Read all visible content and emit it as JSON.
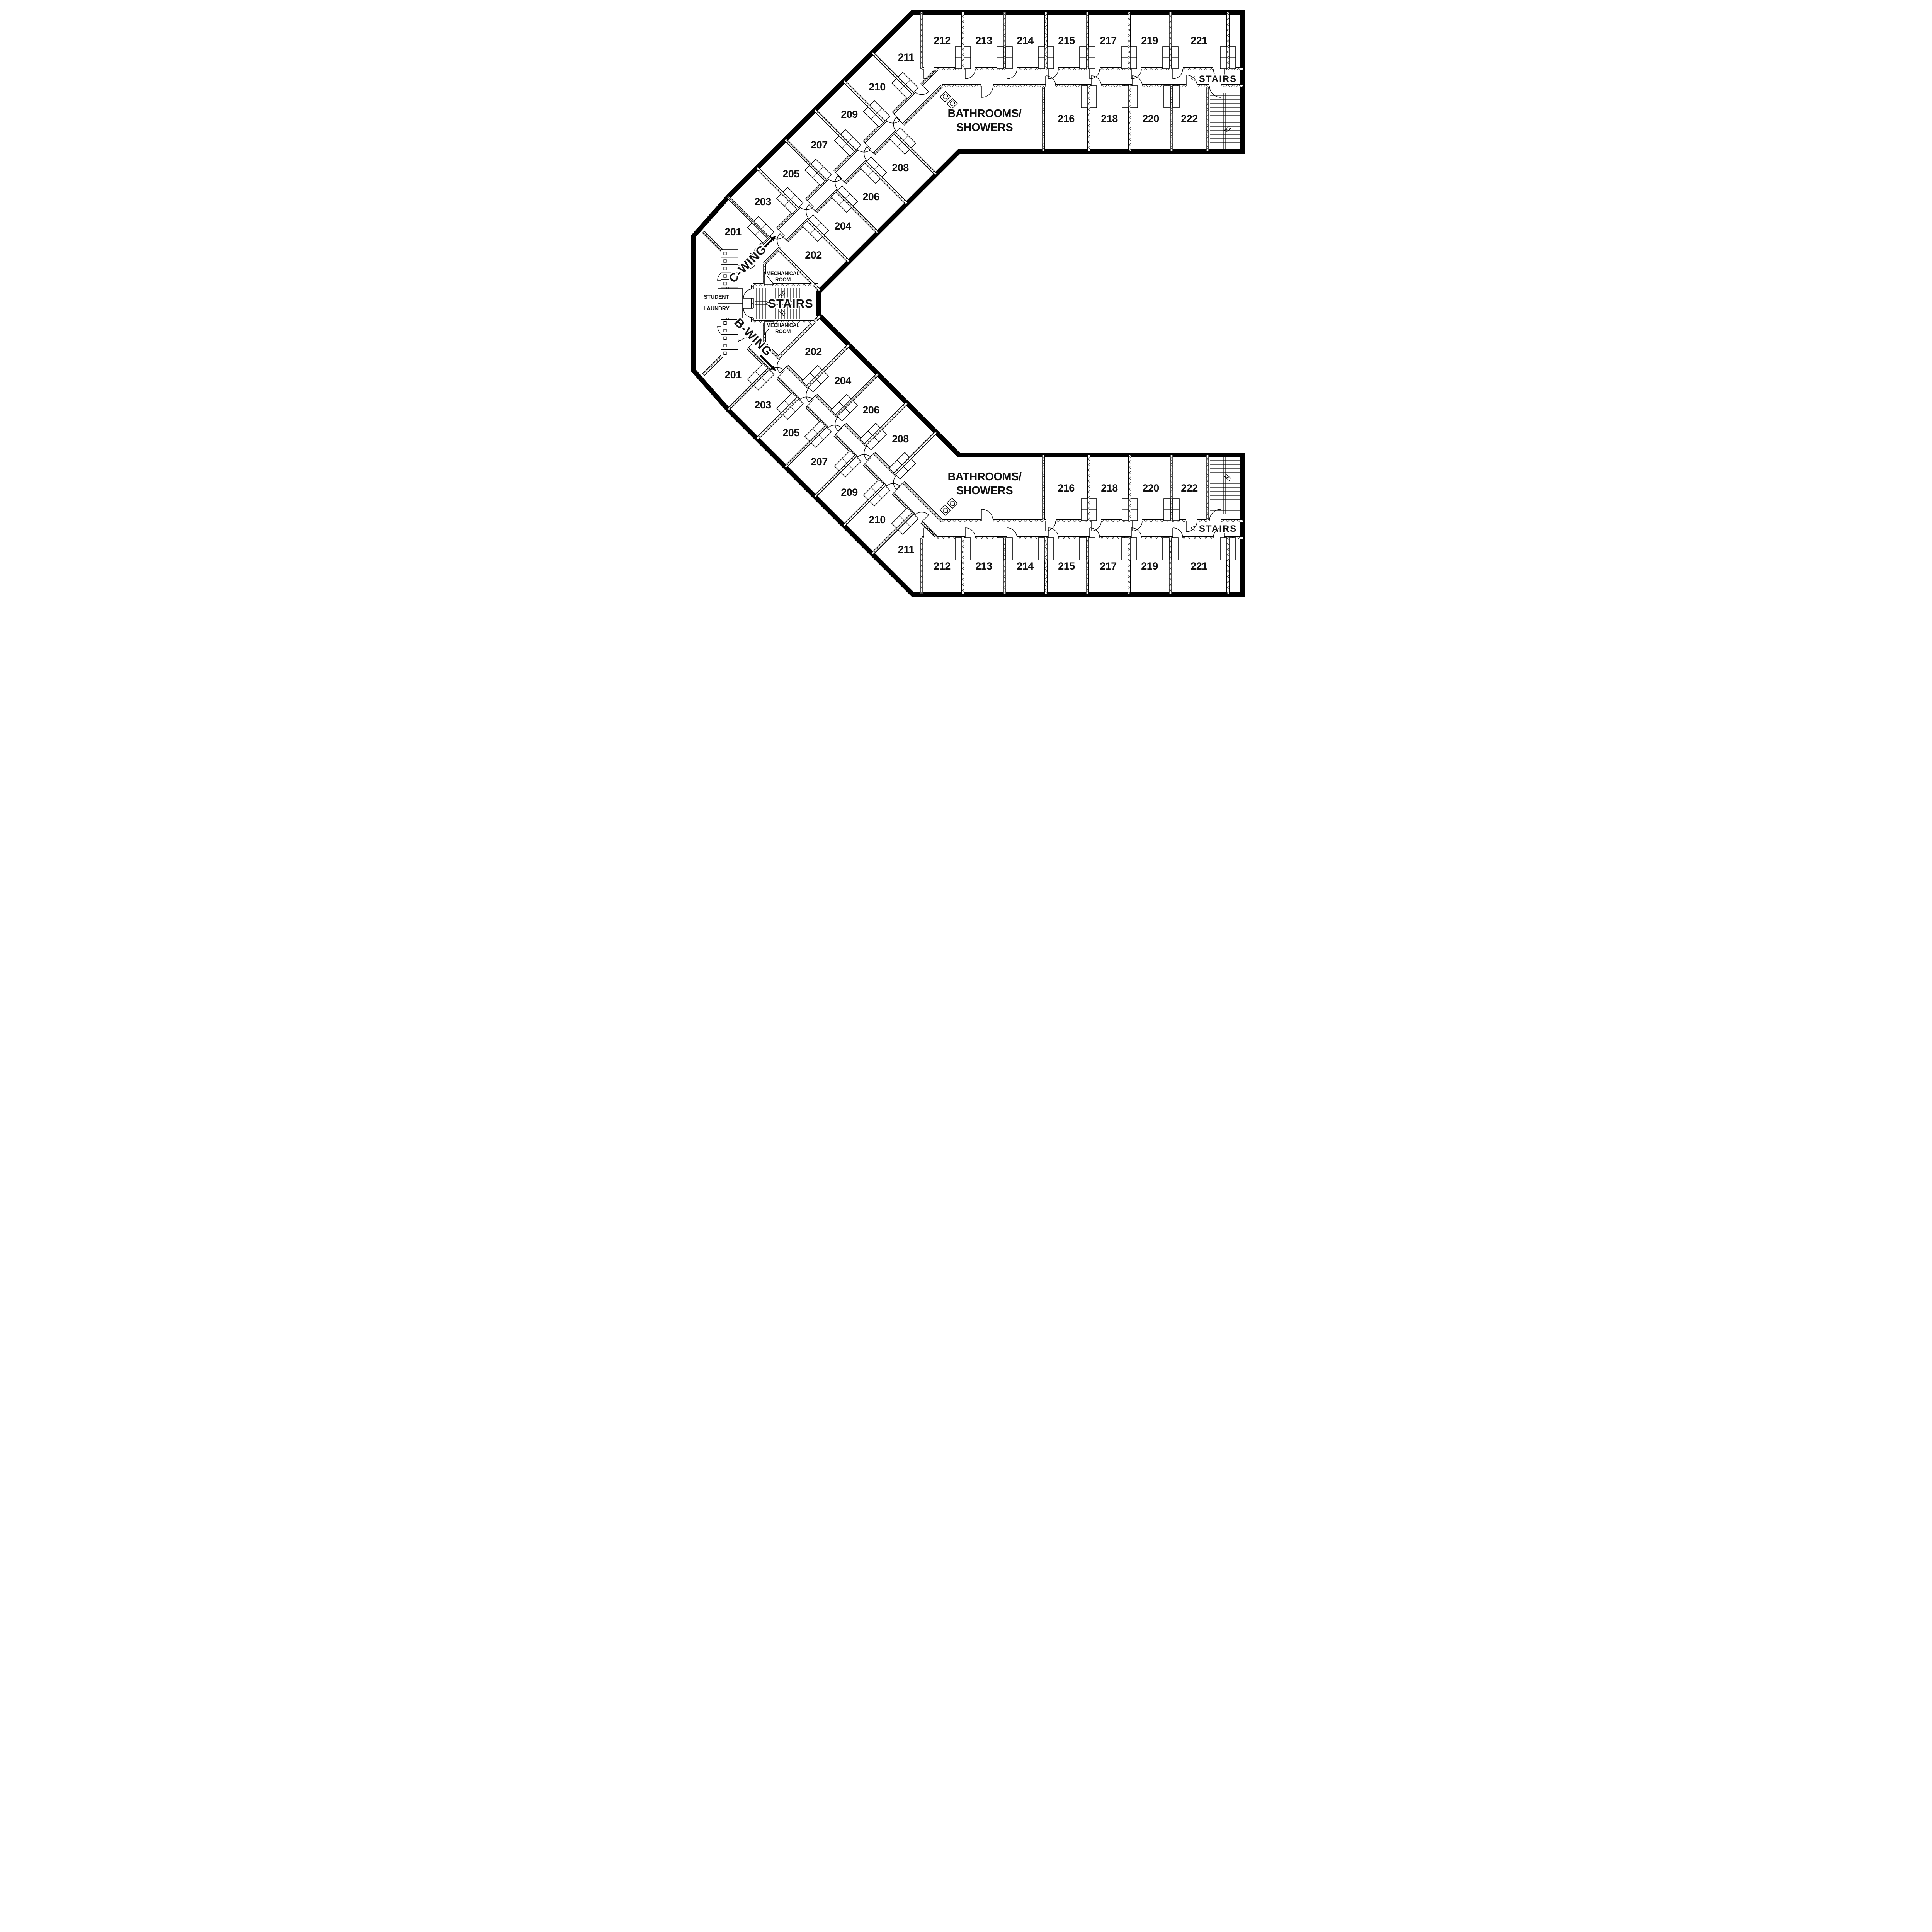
{
  "plan": {
    "wing_labels": {
      "c": "C-WING",
      "b": "B-WING"
    },
    "stairs_label": "STAIRS",
    "mechanical_room": [
      "MECHANICAL",
      "ROOM"
    ],
    "student_laundry": [
      "STUDENT",
      "LAUNDRY"
    ],
    "bathrooms": [
      "BATHROOMS/",
      "SHOWERS"
    ],
    "rooms": {
      "cap_upper": [
        "212",
        "213",
        "214",
        "215",
        "217",
        "219",
        "221"
      ],
      "cap_lower": [
        "216",
        "218",
        "220",
        "222"
      ],
      "diag_outer": [
        "211",
        "210",
        "209",
        "207",
        "205",
        "203",
        "201"
      ],
      "diag_inner": [
        "208",
        "206",
        "204",
        "202"
      ]
    }
  }
}
